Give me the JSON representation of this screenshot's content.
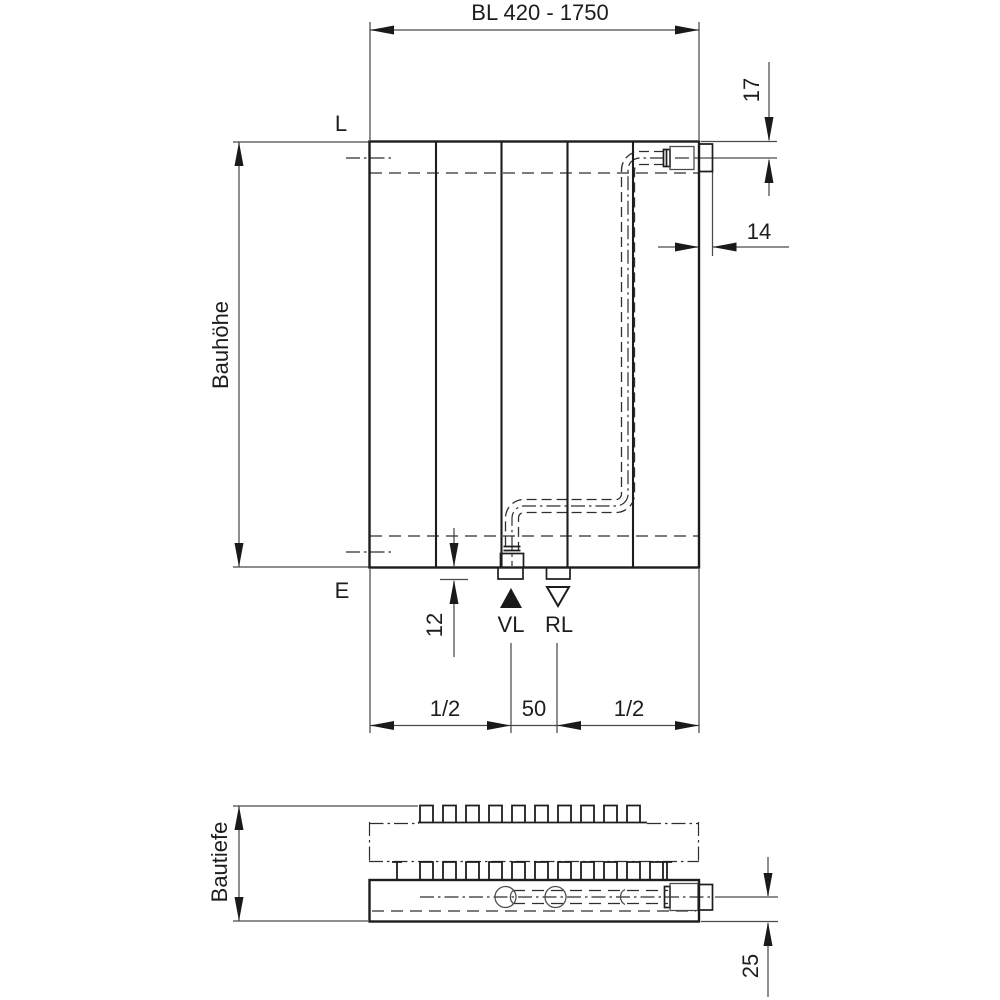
{
  "drawing": {
    "background_color": "#ffffff",
    "line_color": "#1d1d1b",
    "front_view": {
      "length_dimension": "BL 420 - 1750",
      "height_label": "Bauhöhe",
      "top_level_label": "L",
      "bottom_level_label": "E",
      "top_connection_offset": "17",
      "side_connection_offset": "14",
      "bottom_stub_offset": "12",
      "connection_spacing": "50",
      "half_length_left": "1/2",
      "half_length_right": "1/2",
      "supply_label": "VL",
      "return_label": "RL"
    },
    "bottom_view": {
      "depth_label": "Bautiefe",
      "connection_depth_offset": "25"
    }
  }
}
